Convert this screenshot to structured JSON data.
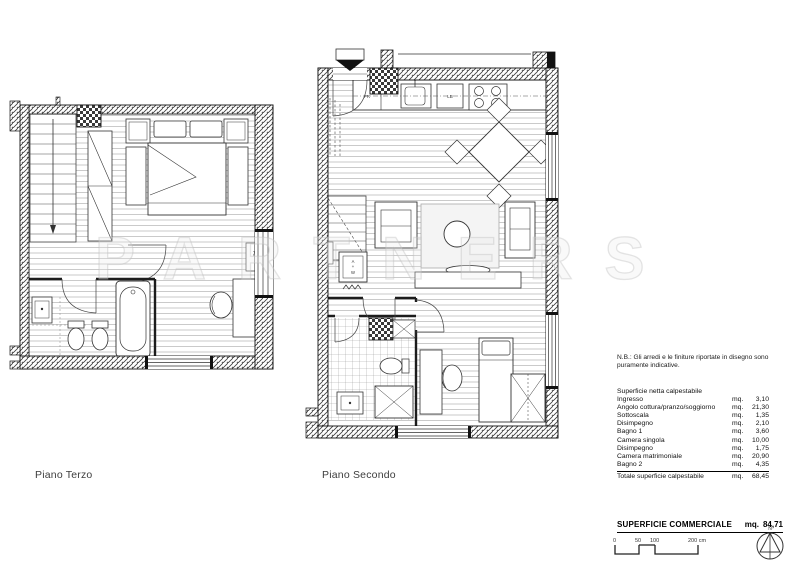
{
  "watermark": "PARTNERS",
  "plans": {
    "left": {
      "label": "Piano Terzo"
    },
    "right": {
      "label": "Piano Secondo"
    }
  },
  "plan_tags": {
    "fridge": "FR",
    "laundry": "LB",
    "radiator": "FC",
    "washer": [
      "A",
      "+",
      "W"
    ]
  },
  "note": "N.B.: Gli arredi e le finiture riportate in disegno sono puramente indicative.",
  "area_table": {
    "title": "Superficie netta calpestabile",
    "rows": [
      {
        "label": "Ingresso",
        "unit": "mq.",
        "value": "3,10"
      },
      {
        "label": "Angolo cottura/pranzo/soggiorno",
        "unit": "mq.",
        "value": "21,30"
      },
      {
        "label": "Sottoscala",
        "unit": "mq.",
        "value": "1,35"
      },
      {
        "label": "Disimpegno",
        "unit": "mq.",
        "value": "2,10"
      },
      {
        "label": "Bagno 1",
        "unit": "mq.",
        "value": "3,60"
      },
      {
        "label": "Camera singola",
        "unit": "mq.",
        "value": "10,00"
      },
      {
        "label": "Disimpegno",
        "unit": "mq.",
        "value": "1,75"
      },
      {
        "label": "Camera matrimoniale",
        "unit": "mq.",
        "value": "20,90"
      },
      {
        "label": "Bagno 2",
        "unit": "mq.",
        "value": "4,35"
      }
    ],
    "total": {
      "label": "Totale superficie calpestabile",
      "unit": "mq.",
      "value": "68,45"
    }
  },
  "commercial": {
    "label": "SUPERFICIE COMMERCIALE",
    "unit": "mq.",
    "value": "84,71"
  },
  "scale_bar": {
    "ticks": [
      "0",
      "50",
      "100",
      "200 cm"
    ]
  },
  "north": {
    "label": "N"
  }
}
